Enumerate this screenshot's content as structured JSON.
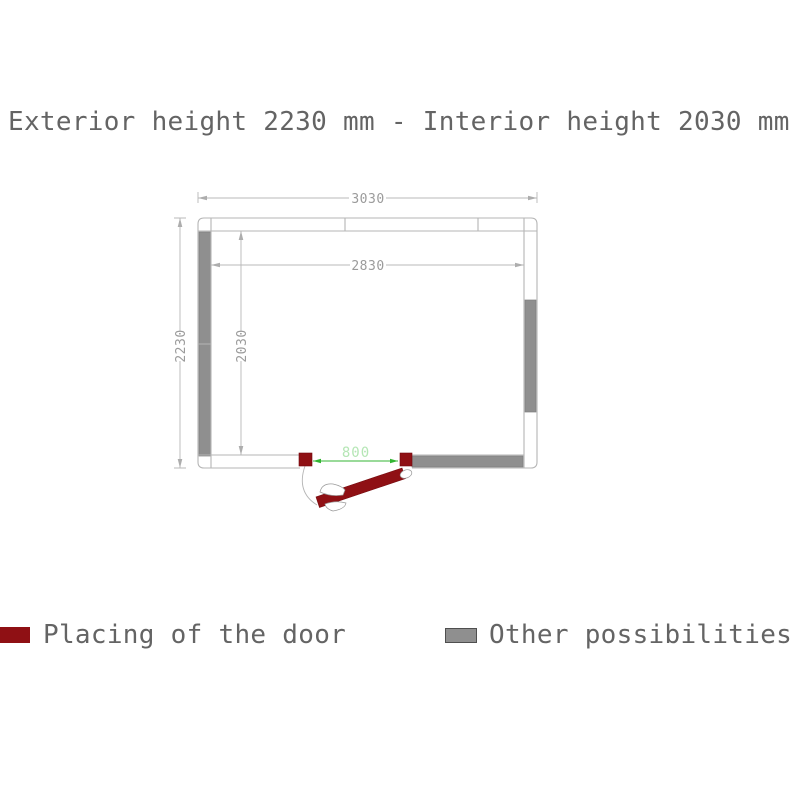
{
  "title": "Exterior height 2230 mm - Interior height 2030 mm",
  "plan": {
    "dims": {
      "exterior_width": "3030",
      "interior_width": "2830",
      "exterior_depth": "2230",
      "interior_depth": "2030",
      "door_width": "800"
    }
  },
  "legend": {
    "door_label": "Placing of the door",
    "other_label": "Other possibilities"
  },
  "colors": {
    "door_red": "#8f1014",
    "possibility_gray": "#8f8f8f",
    "wall_line": "#b5b5b5",
    "dim_line": "#b8b8b8",
    "dim_text": "#9b9b9b",
    "door_dim_green": "#33b533",
    "door_dim_text_green": "#b5e6b5",
    "label_text": "#646464"
  }
}
